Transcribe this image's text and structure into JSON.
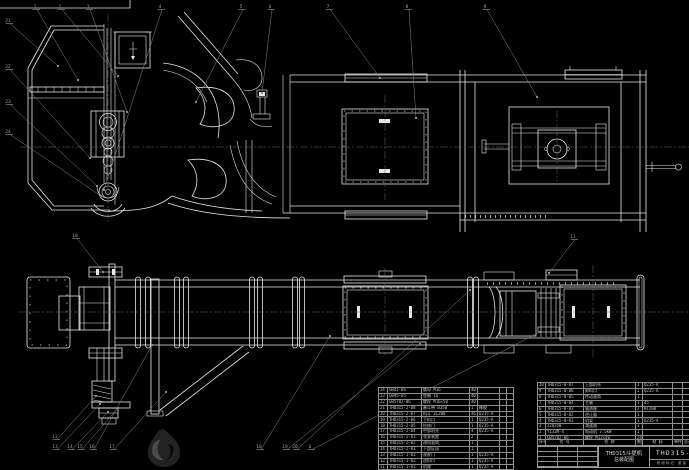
{
  "title_block": {
    "model": "THD315斗提机",
    "name": "总装配图",
    "drawing_no": "THD315-00",
    "info_row": "阶段标记  重量  比例"
  },
  "bom": {
    "header_rows": [
      [
        "序号",
        "代  号",
        "名  称",
        "数量",
        "材  料",
        "单件",
        "总计",
        "备注"
      ]
    ],
    "left_rows": [
      [
        "24",
        "GB41-86",
        "螺母 M16",
        "40",
        "",
        "",
        ""
      ],
      [
        "23",
        "GB95-85",
        "垫圈 16",
        "40",
        "",
        "",
        ""
      ],
      [
        "22",
        "GB5782-86",
        "螺栓 M16×50",
        "40",
        "",
        "",
        ""
      ],
      [
        "21",
        "THD315-2-08",
        "畚斗带 B350",
        "1",
        "橡胶",
        "",
        ""
      ],
      [
        "20",
        "THD315-2-07",
        "料斗 ZL280",
        "46",
        "Q235-A",
        "",
        ""
      ],
      [
        "19",
        "THD315-2-06",
        "下料口",
        "1",
        "Q235-A",
        "",
        ""
      ],
      [
        "18",
        "THD315-2-05",
        "检修门",
        "1",
        "Q235-A",
        "",
        ""
      ],
      [
        "17",
        "THD315-2-04",
        "中部机壳",
        "4",
        "Q235-A",
        "",
        ""
      ],
      [
        "16",
        "THD315-2-03",
        "张紧装置",
        "2",
        "",
        "",
        ""
      ],
      [
        "15",
        "THD315-2-02",
        "改向滚筒",
        "1",
        "",
        "",
        ""
      ],
      [
        "14",
        "THD315-2-01",
        "下部区段",
        "1",
        "",
        "",
        ""
      ],
      [
        "13",
        "THD315-1-03",
        "观察门",
        "1",
        "Q235-A",
        "",
        ""
      ],
      [
        "12",
        "THD315-1-02",
        "进料口",
        "1",
        "Q235-A",
        "",
        ""
      ],
      [
        "11",
        "THD315-1-01",
        "机座",
        "1",
        "Q235-A",
        "",
        ""
      ]
    ],
    "right_rows": [
      [
        "10",
        "THD315-0-07",
        "上部机壳",
        "1",
        "Q235-A",
        "",
        ""
      ],
      [
        "9",
        "THD315-0-06",
        "卸料口",
        "1",
        "Q235-A",
        "",
        ""
      ],
      [
        "8",
        "THD315-0-05",
        "传动滚筒",
        "1",
        "",
        "",
        ""
      ],
      [
        "7",
        "THD315-0-04",
        "主轴",
        "1",
        "45",
        "",
        ""
      ],
      [
        "6",
        "THD315-0-03",
        "轴承座",
        "2",
        "HT200",
        "",
        ""
      ],
      [
        "5",
        "THD315-0-02",
        "逆止器",
        "1",
        "",
        "",
        ""
      ],
      [
        "4",
        "THD315-0-01",
        "机架",
        "1",
        "Q235-A",
        "",
        ""
      ],
      [
        "3",
        "JZQ350",
        "减速器",
        "1",
        "",
        "",
        ""
      ],
      [
        "2",
        "Y132M-4",
        "电动机 7.5kW",
        "1",
        "",
        "",
        ""
      ],
      [
        "1",
        "GB5782-86",
        "螺栓 M12×40",
        "24",
        "",
        "",
        ""
      ]
    ]
  },
  "balloons": [
    {
      "n": "1",
      "x": 35,
      "y": 8,
      "lx": 78,
      "ly": 80
    },
    {
      "n": "2",
      "x": 60,
      "y": 8,
      "lx": 118,
      "ly": 76
    },
    {
      "n": "3",
      "x": 88,
      "y": 8,
      "lx": 127,
      "ly": 112
    },
    {
      "n": "4",
      "x": 160,
      "y": 8,
      "lx": 104,
      "ly": 190
    },
    {
      "n": "5",
      "x": 241,
      "y": 8,
      "lx": 196,
      "ly": 102
    },
    {
      "n": "6",
      "x": 270,
      "y": 8,
      "lx": 262,
      "ly": 93
    },
    {
      "n": "7",
      "x": 328,
      "y": 8,
      "lx": 380,
      "ly": 78
    },
    {
      "n": "8",
      "x": 407,
      "y": 8,
      "lx": 416,
      "ly": 118
    },
    {
      "n": "9",
      "x": 485,
      "y": 8,
      "lx": 537,
      "ly": 97
    },
    {
      "n": "21",
      "x": 8,
      "y": 22,
      "lx": 58,
      "ly": 66
    },
    {
      "n": "22",
      "x": 8,
      "y": 68,
      "lx": 90,
      "ly": 158
    },
    {
      "n": "23",
      "x": 8,
      "y": 103,
      "lx": 97,
      "ly": 186
    },
    {
      "n": "24",
      "x": 8,
      "y": 133,
      "lx": 101,
      "ly": 196
    },
    {
      "n": "10",
      "x": 75,
      "y": 237,
      "lx": 103,
      "ly": 272
    },
    {
      "n": "11",
      "x": 573,
      "y": 238,
      "lx": 549,
      "ly": 273
    },
    {
      "n": "12",
      "x": 55,
      "y": 438,
      "lx": 96,
      "ly": 396
    },
    {
      "n": "13",
      "x": 55,
      "y": 448,
      "lx": 100,
      "ly": 404
    },
    {
      "n": "14",
      "x": 70,
      "y": 448,
      "lx": 108,
      "ly": 412
    },
    {
      "n": "15",
      "x": 80,
      "y": 448,
      "lx": 118,
      "ly": 408
    },
    {
      "n": "16",
      "x": 92,
      "y": 448,
      "lx": 152,
      "ly": 345
    },
    {
      "n": "17",
      "x": 112,
      "y": 448,
      "lx": 166,
      "ly": 392
    },
    {
      "n": "18",
      "x": 259,
      "y": 448,
      "lx": 330,
      "ly": 336
    },
    {
      "n": "19",
      "x": 285,
      "y": 448,
      "lx": 420,
      "ly": 344
    },
    {
      "n": "20",
      "x": 295,
      "y": 448,
      "lx": 470,
      "ly": 290
    },
    {
      "n": "6",
      "x": 310,
      "y": 448,
      "lx": 540,
      "ly": 332
    }
  ]
}
